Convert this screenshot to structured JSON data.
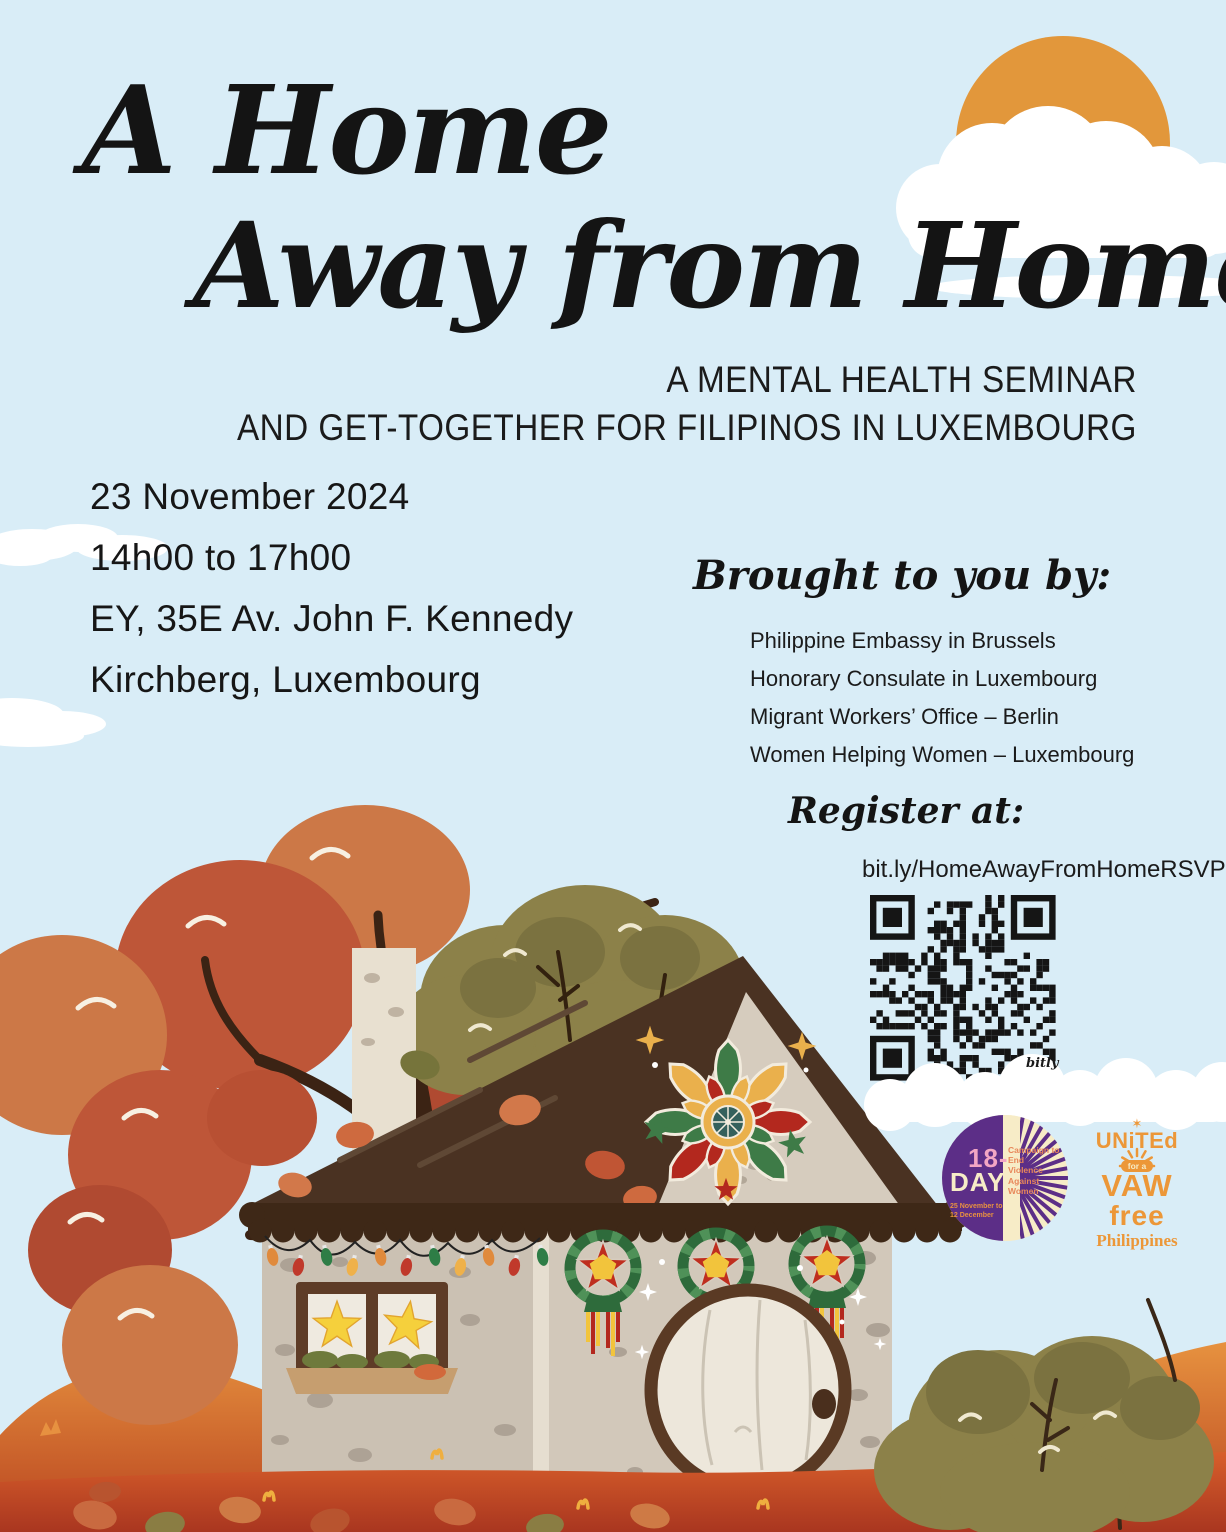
{
  "poster": {
    "title_line1": "A Home",
    "title_line2": "Away from Home",
    "subtitle_line1": "A MENTAL HEALTH SEMINAR",
    "subtitle_line2": "AND GET-TOGETHER FOR FILIPINOS IN LUXEMBOURG",
    "event": {
      "lines": [
        "23 November 2024",
        "14h00 to 17h00",
        "EY, 35E Av. John F. Kennedy",
        "Kirchberg, Luxembourg"
      ]
    },
    "brought_by": {
      "heading": "Brought to you by:",
      "organizations": [
        "Philippine Embassy in Brussels",
        "Honorary Consulate in Luxembourg",
        "Migrant Workers’ Office – Berlin",
        "Women Helping Women – Luxembourg"
      ]
    },
    "register": {
      "heading": "Register at:",
      "url": "bit.ly/HomeAwayFromHomeRSVP",
      "qr_provider": "bitly"
    },
    "logos": {
      "eighteen_day": {
        "line1": "18-",
        "line2": "DAY",
        "dates": "25 November to 12 December",
        "campaign": "Campaign to End Violence Against Women"
      },
      "vaw_free": {
        "star": "✶",
        "line1": "UNiTEd",
        "line2": "for a",
        "line3": "VAW",
        "line4": "free",
        "line5": "Philippines"
      }
    },
    "colors": {
      "background": "#D9EDF7",
      "ink": "#171717",
      "sun": "#E2973B",
      "cloud": "#FFFFFF",
      "roof": "#4A3222",
      "roof_trim": "#3E2817",
      "wall": "#D2C8BA",
      "gable": "#D6CCBE",
      "parol_green": "#2E6B3B",
      "parol_red": "#BF2E1F",
      "parol_yellow": "#F2C43C",
      "ground_light": "#EC9B43",
      "ground_dark": "#AB3920",
      "tree_rust": "#BE5638",
      "tree_orange": "#CC7847",
      "bush_olive": "#8C8149",
      "logo_purple": "#5C2E87",
      "logo_orange": "#EC9738",
      "qr": "#151515"
    }
  }
}
